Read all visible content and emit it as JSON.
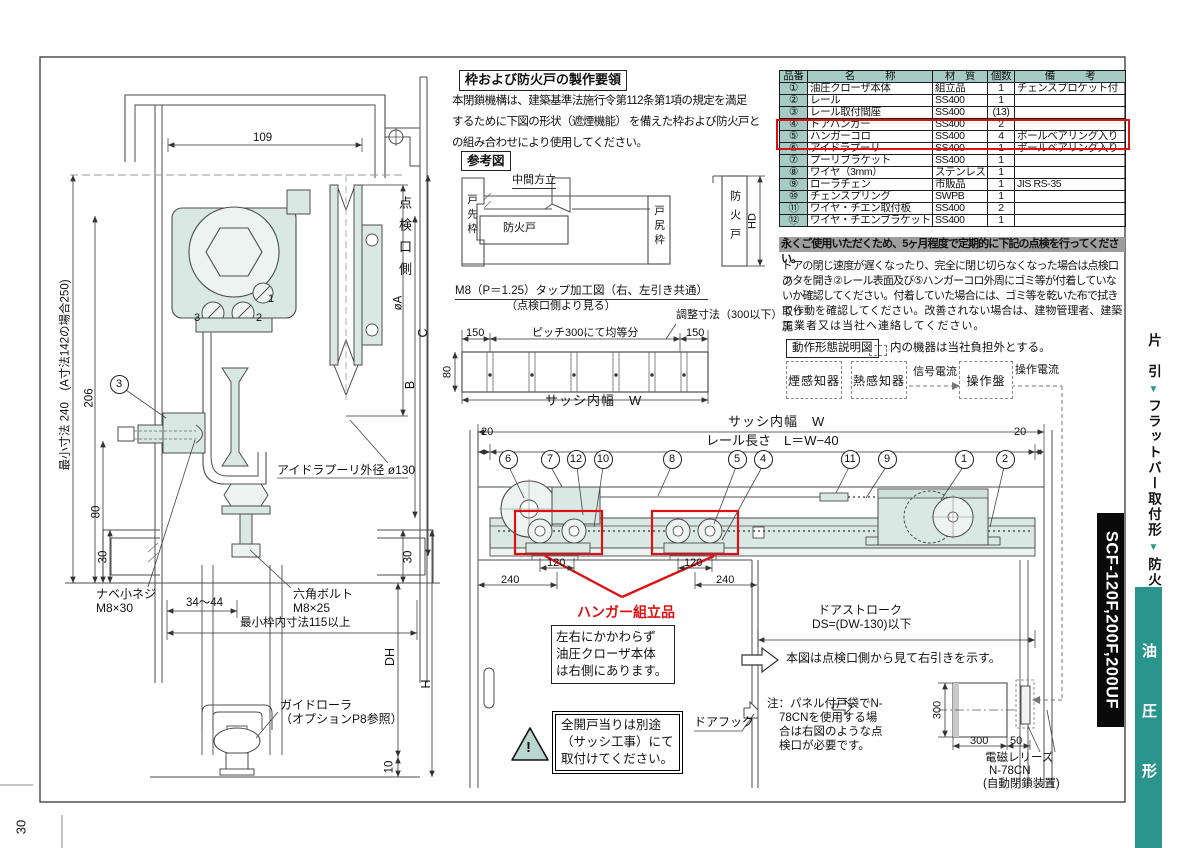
{
  "page_number": "30",
  "sidebar": {
    "breadcrumb_items": [
      "片　引",
      "フラットバー取付形",
      "防火扉"
    ],
    "separator": "▼",
    "model": "SCF-120F,200F,200UF",
    "series": "油 圧 形",
    "accent_color": "#2a958d"
  },
  "fabr": {
    "title": "枠および防火戸の製作要領",
    "line1": "本閉鎖機構は、建築基準法施行令第112条第1項の規定を満足",
    "line2": "するために下図の形状（遮煙機能） を備えた枠および防火戸と",
    "line3": "の組み合わせにより使用してください。",
    "ref_label": "参考図",
    "front_jamb": "戸先枠",
    "mullion": "中間方立",
    "door": "防火戸",
    "rear_jamb": "戸尻枠",
    "right_door": "防火戸",
    "height_dim": "HD"
  },
  "tap": {
    "title": "M8（P＝1.25）タップ加工図（右、左引き共通）",
    "subtitle": "（点検口側より見る）",
    "adjust": "調整寸法（300以下）",
    "dim_left": "150",
    "pitch": "ピッチ300にて均等分",
    "dim_right": "150",
    "dim_height": "80",
    "width_label": "サッシ内幅　W"
  },
  "parts_table": {
    "headers": {
      "no": "品番",
      "name": "名　　　称",
      "material": "材　質",
      "qty": "個数",
      "note": "備　　　考"
    },
    "rows": [
      {
        "no": "①",
        "name": "油圧クローザ本体",
        "material": "組立品",
        "qty": "1",
        "note": "チェンスプロケット付"
      },
      {
        "no": "②",
        "name": "レール",
        "material": "SS400",
        "qty": "1",
        "note": ""
      },
      {
        "no": "③",
        "name": "レール取付間座",
        "material": "SS400",
        "qty": "(13)",
        "note": ""
      },
      {
        "no": "④",
        "name": "ドアハンガー",
        "material": "SS400",
        "qty": "2",
        "note": ""
      },
      {
        "no": "⑤",
        "name": "ハンガーコロ",
        "material": "SS400",
        "qty": "4",
        "note": "ボールベアリング入り"
      },
      {
        "no": "⑥",
        "name": "アイドラプーリ",
        "material": "SS400",
        "qty": "1",
        "note": "ボールベアリング入り"
      },
      {
        "no": "⑦",
        "name": "プーリブラケット",
        "material": "SS400",
        "qty": "1",
        "note": ""
      },
      {
        "no": "⑧",
        "name": "ワイヤ（3mm）",
        "material": "ステンレス",
        "qty": "1",
        "note": ""
      },
      {
        "no": "⑨",
        "name": "ローラチェン",
        "material": "市販品",
        "qty": "1",
        "note": "JIS RS-35"
      },
      {
        "no": "⑩",
        "name": "チェンスプリング",
        "material": "SWPB",
        "qty": "1",
        "note": ""
      },
      {
        "no": "⑪",
        "name": "ワイヤ・チエン取付板",
        "material": "SS400",
        "qty": "2",
        "note": ""
      },
      {
        "no": "⑫",
        "name": "ワイヤ・チエンブラケット",
        "material": "SS400",
        "qty": "1",
        "note": ""
      }
    ]
  },
  "maintenance": {
    "header": "永くご使用いただくため、5ヶ月程度で定期的に下記の点検を行ってください。",
    "line1": "ドアの閉じ速度が遅くなったり、完全に閉じ切らなくなった場合は点検口の",
    "line2": "フタを開き②レール表面及び⑤ハンガーコロ外周にゴミ等が付着していな",
    "line3": "いか確認してください。付着していた場合には、ゴミ等を乾いた布で拭き取っ",
    "line4": "て作動を確認してください。改善されない場合は、建物管理者、建築施",
    "line5": "工業者又は当社へ連絡してください。"
  },
  "operation": {
    "title": "動作形態説明図",
    "note": "内の機器は当社負担外とする。",
    "box1": "煙感知器",
    "box2": "熱感知器",
    "box3": "操作盤",
    "signal": "信号電流",
    "control": "操作電流"
  },
  "left_drawing": {
    "dim_109": "109",
    "inspection_side": "点検口側",
    "dia_a": "øA",
    "dim_c": "C",
    "dim_b": "B",
    "min_dim": "最小寸法 240　(A寸法142の場合250)",
    "dim_206": "206",
    "dim_80": "80",
    "dim_30": "30",
    "part3": "3",
    "screw1": "1",
    "screw2": "2",
    "screw3": "3",
    "idler": "アイドラプーリ外径 ø130",
    "pan1": "ナベ小ネジ",
    "pan2": "M8×30",
    "range": "34～44",
    "hex1": "六角ボルト",
    "hex2": "M8×25",
    "min_frame": "最小枠内寸法115以上",
    "dh": "DH",
    "h": "H",
    "dim_10": "10",
    "guide1": "ガイドローラ",
    "guide2": "（オプションP8参照）"
  },
  "rail_drawing": {
    "sash_width": "サッシ内幅　W",
    "rail_length": "レール長さ　L＝W−40",
    "dim_20": "20",
    "callouts": [
      "6",
      "7",
      "12",
      "10",
      "8",
      "5",
      "4",
      "11",
      "9",
      "1",
      "2"
    ],
    "dim_120": "120",
    "dim_240": "240",
    "hanger_label": "ハンガー組立品",
    "note1": "左右にかかわらず",
    "note2": "油圧クローザ本体",
    "note3": "は右側にあります。",
    "warning_mark": "!",
    "warn1": "全開戸当りは別途",
    "warn2": "（サッシ工事）にて",
    "warn3": "取付けてください。",
    "door_hook": "ドアフック",
    "stroke1": "ドアストローク",
    "stroke2": "DS=(DW-130)以下",
    "direction_note": "本図は点検口側から見て右引きを示す。",
    "pocket1": "注：パネル付戸袋でN-",
    "pocket2": "78CNを使用する場",
    "pocket3": "合は右図のような点",
    "pocket4": "検口が必要です。",
    "dim_300": "300",
    "dim_50": "50",
    "release1": "電磁レリーズ",
    "release2": "N-78CN",
    "release3": "(自動閉鎖装置)"
  }
}
